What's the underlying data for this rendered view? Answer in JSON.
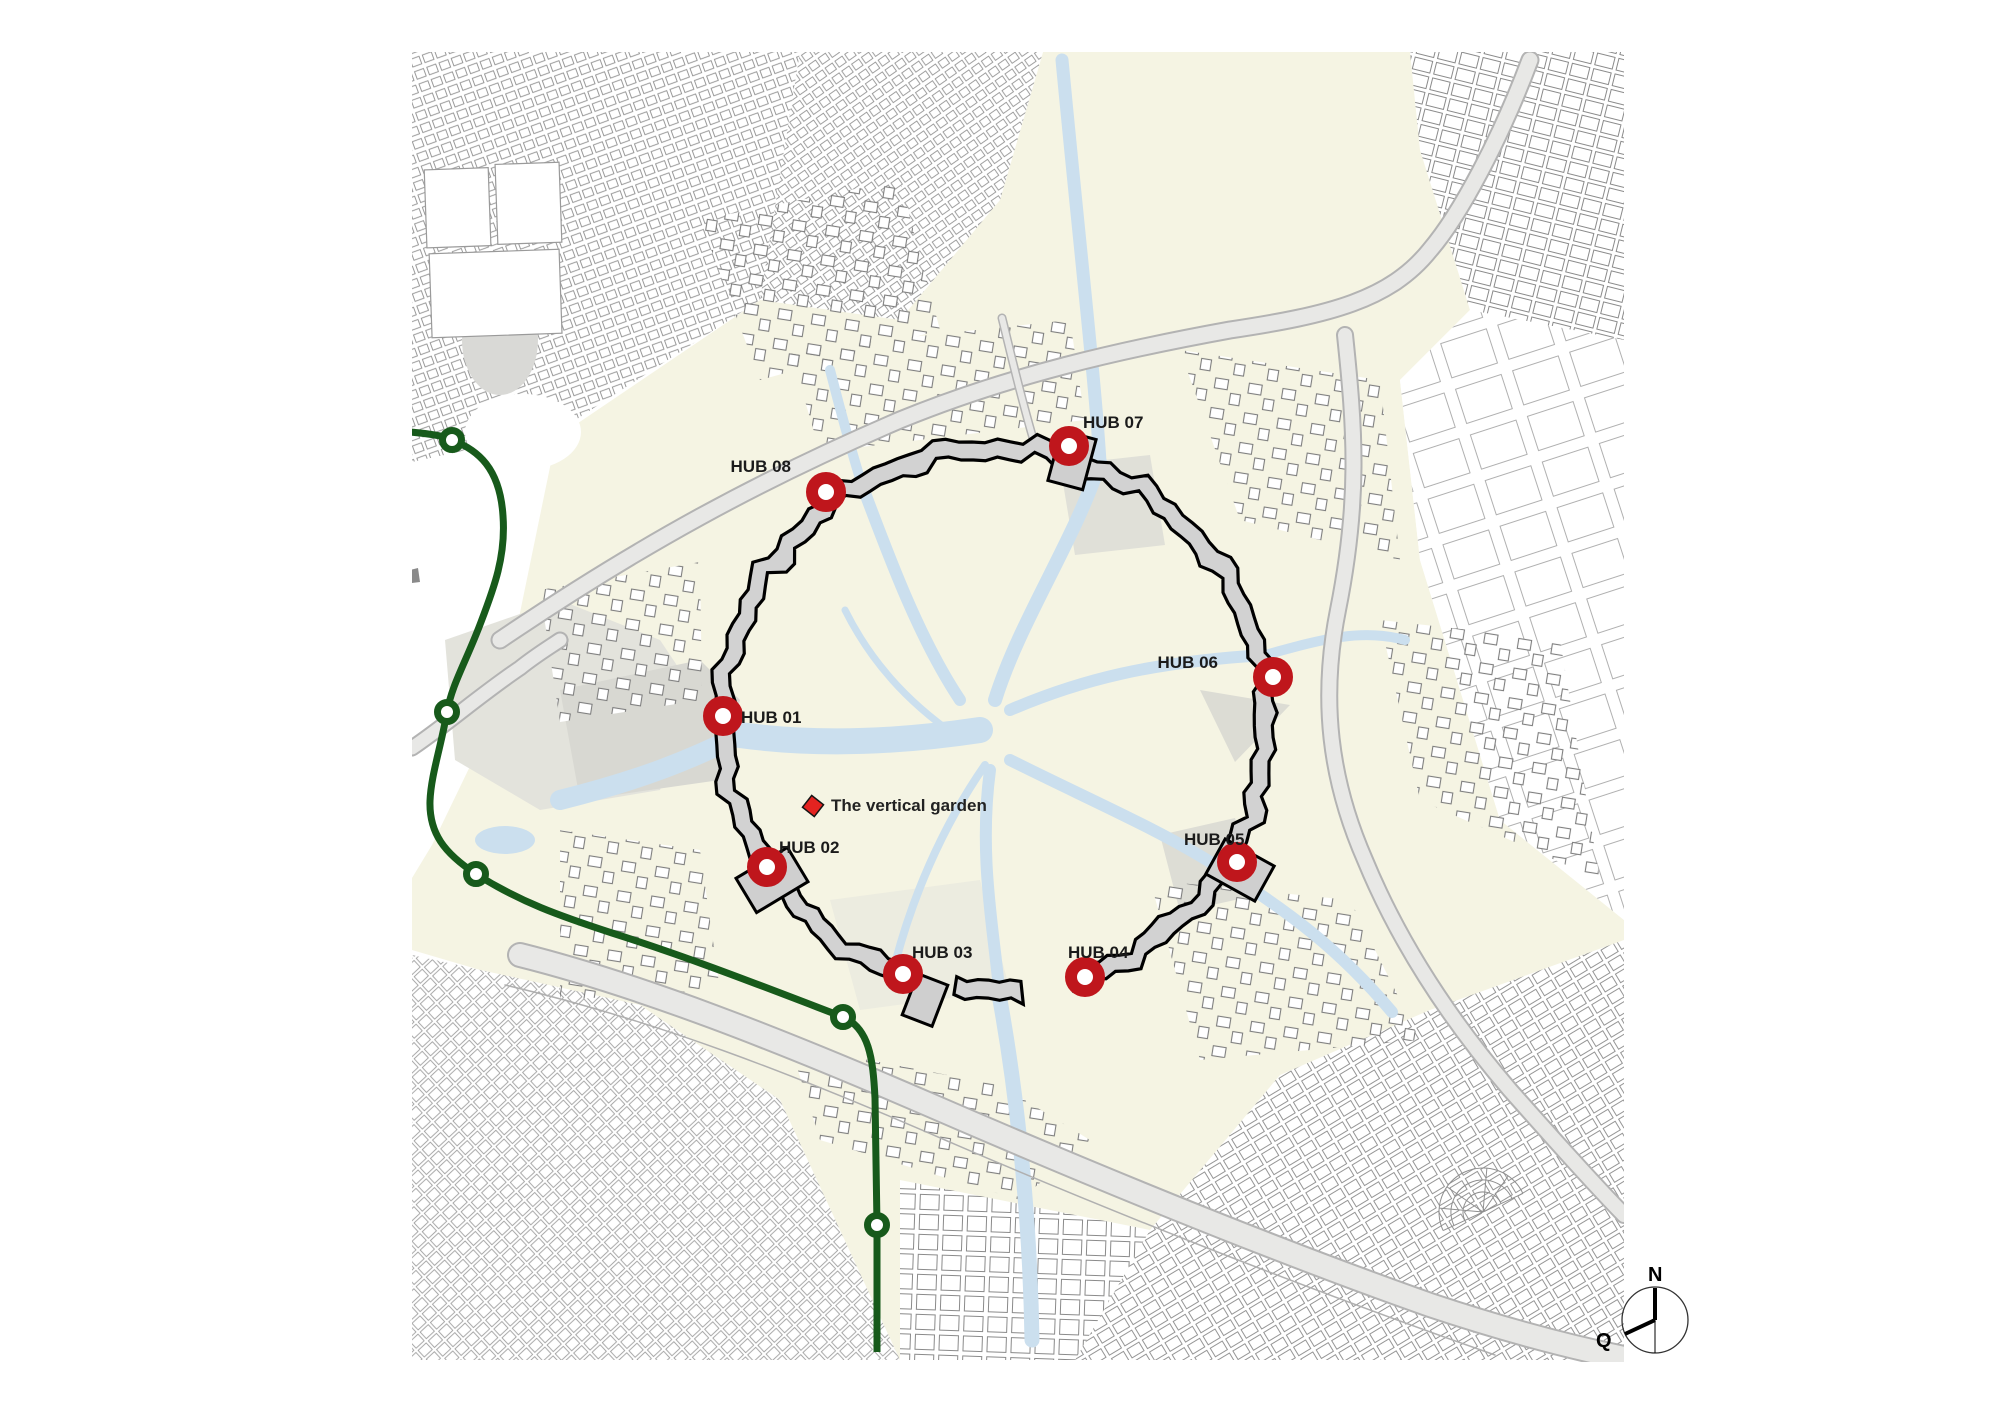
{
  "page": {
    "background": "#ffffff"
  },
  "map": {
    "colors": {
      "land": "#f5f4e3",
      "water": "#cbdfee",
      "wall_fill": "#d2d2d2",
      "wall_stroke": "#000000",
      "road_fill": "#e8e8e6",
      "road_casing": "#b3b3b3",
      "hub_marker": "#bf161c",
      "garden_marker": "#e42320",
      "transit_line": "#175a1b",
      "building_stroke": "#8f8f8f"
    },
    "hubs": [
      {
        "label": "HUB 01",
        "x": 723,
        "y": 716,
        "label_dx": 18,
        "label_dy": 7,
        "anchor": "start"
      },
      {
        "label": "HUB 02",
        "x": 767,
        "y": 867,
        "label_dx": 12,
        "label_dy": -14,
        "anchor": "start"
      },
      {
        "label": "HUB 03",
        "x": 903,
        "y": 974,
        "label_dx": 9,
        "label_dy": -16,
        "anchor": "start"
      },
      {
        "label": "HUB 04",
        "x": 1085,
        "y": 977,
        "label_dx": -17,
        "label_dy": -19,
        "anchor": "start"
      },
      {
        "label": "HUB 05",
        "x": 1237,
        "y": 862,
        "label_dx": -53,
        "label_dy": -17,
        "anchor": "start"
      },
      {
        "label": "HUB 06",
        "x": 1273,
        "y": 677,
        "label_dx": -55,
        "label_dy": -9,
        "anchor": "end"
      },
      {
        "label": "HUB 07",
        "x": 1069,
        "y": 446,
        "label_dx": 14,
        "label_dy": -18,
        "anchor": "start"
      },
      {
        "label": "HUB 08",
        "x": 826,
        "y": 492,
        "label_dx": -35,
        "label_dy": -20,
        "anchor": "end"
      }
    ],
    "landmark": {
      "label": "The vertical garden",
      "x": 813,
      "y": 806,
      "label_dx": 18,
      "label_dy": 5
    },
    "transit": {
      "color": "#175a1b",
      "nodes": [
        [
          452,
          440
        ],
        [
          447,
          712
        ],
        [
          476,
          874
        ],
        [
          843,
          1017
        ],
        [
          877,
          1225
        ]
      ]
    },
    "compass": {
      "north": "N",
      "west": "Q",
      "cx": 1655,
      "cy": 1320,
      "r": 33
    }
  }
}
